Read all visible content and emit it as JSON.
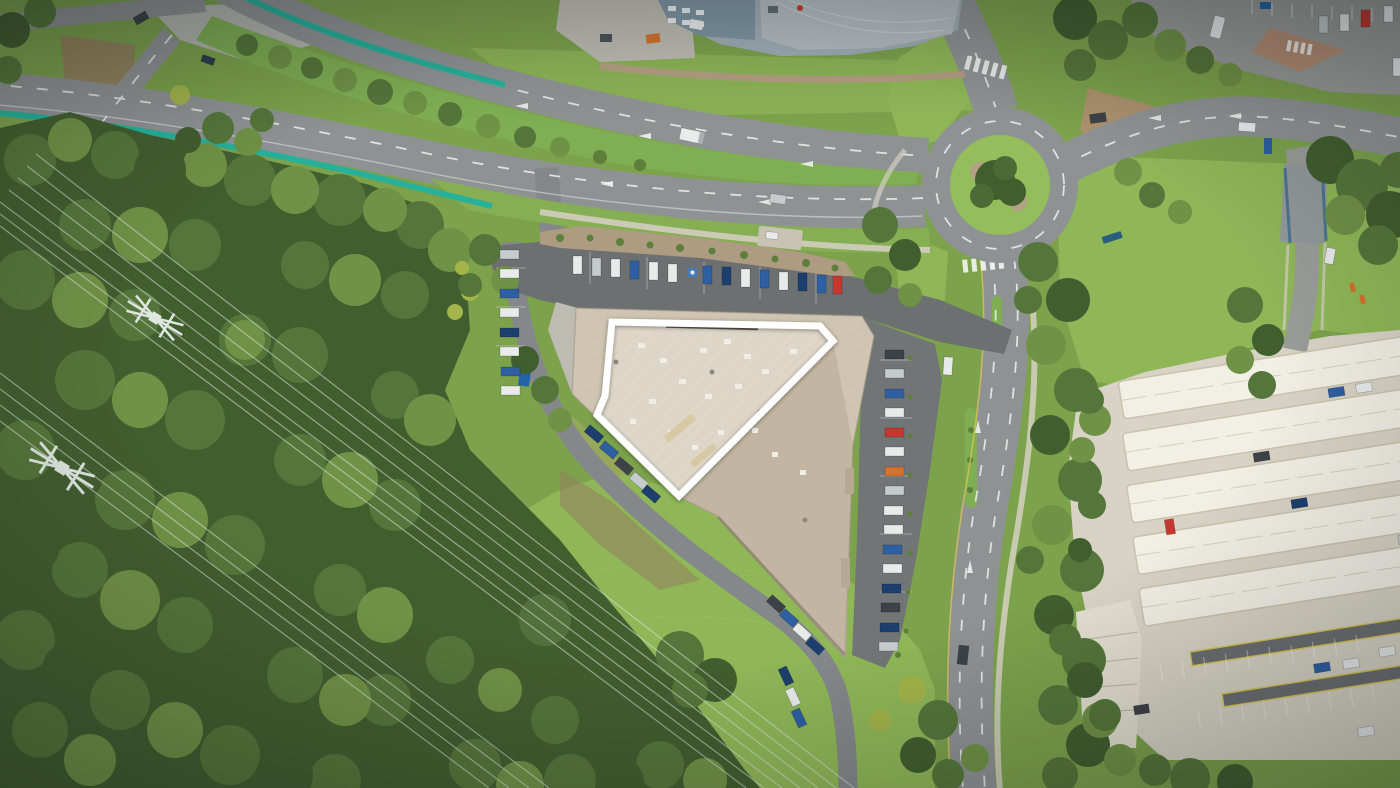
{
  "meta": {
    "title": "Top-down aerial drone photo of a commercial retail property; the featured building roof is outlined in white",
    "type": "aerial-photograph",
    "view": "top-down",
    "width_px": 1400,
    "height_px": 788
  },
  "highlight": {
    "name": "property-boundary-outline",
    "points": "612,322 820,326 833,341 679,496 597,415 605,396",
    "stroke_width": 7,
    "color": "#ffffff"
  },
  "landmarks": [
    {
      "id": "highlighted-building",
      "label": "Featured retail building with tan roof outlined in white"
    },
    {
      "id": "main-avenue",
      "label": "Divided avenue with tree median and teal cycle lanes"
    },
    {
      "id": "roundabout",
      "label": "Roundabout with landscaped green island"
    },
    {
      "id": "north-parking",
      "label": "Customer parking rows north of building"
    },
    {
      "id": "shade-sail-carpark",
      "label": "Shade-sail covered car park, south-east"
    },
    {
      "id": "bushland",
      "label": "Dense bushland reserve, west"
    },
    {
      "id": "transmission-corridor",
      "label": "Power transmission towers and wires"
    },
    {
      "id": "meadow",
      "label": "Open grass field, south"
    },
    {
      "id": "industrial-building",
      "label": "Grey industrial building, top"
    }
  ],
  "vehicles": {
    "north_row_count": 14,
    "west_column_count": 8,
    "east_column_count": 16,
    "driveway_count": 13,
    "roads_count": 8
  },
  "colors": {
    "baseGrass": "#7ca24c",
    "meadow": "#8fb757",
    "scrub": "#97a75c",
    "median": "#7fae53",
    "forestDark": "#415e2f",
    "forestMid": "#55763a",
    "treeLight": "#6f9246",
    "treeYellow": "#a3b44a",
    "shrub": "#5d7f3a",
    "roadAsphalt": "#8f9293",
    "roadLight": "#9a9c99",
    "parkingAsphalt": "#6c7071",
    "parkingAsphalt2": "#717576",
    "driveAsphalt": "#85888a",
    "concrete": "#d8d3c5",
    "concretePale": "#e3dfd0",
    "apron": "#bdbbb2",
    "canopyWhite": "#f2efe5",
    "canopyShadow": "#c9c2ae",
    "roofHighlight": "#ded7c8",
    "roofMain": "#cfc5b2",
    "roofDark": "#c2b6a2",
    "bldgGray": "#9fadb5",
    "bldgGrayDark": "#7e95a3",
    "bldgRoofLight": "#b6bdc1",
    "brick": "#b58e74",
    "mulch": "#ad9c82",
    "dirt": "#95805f",
    "teal": "#27b09a",
    "marking": "#f4f6f4",
    "yellowLine": "#d9c54e",
    "carWhite": "#e9ebeb",
    "carSilver": "#c6cbcd",
    "carBlue": "#2e5fa3",
    "carNavy": "#1d3f6e",
    "carRed": "#c63730",
    "carDark": "#3c4248",
    "carOrange": "#d4712c",
    "towerGray": "#dfe5df",
    "wire": "#d5e8e0",
    "highlight": "#ffffff"
  }
}
